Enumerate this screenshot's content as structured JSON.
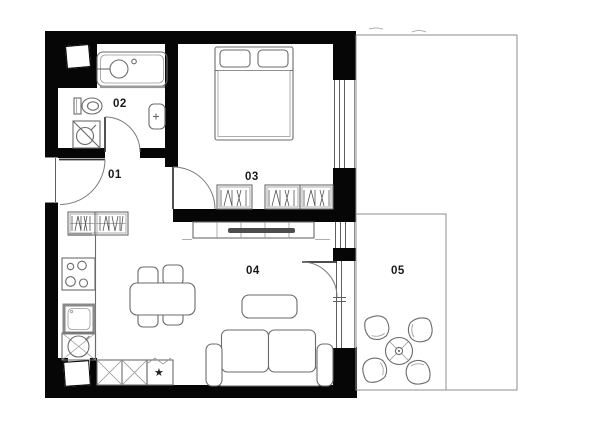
{
  "plan": {
    "rooms": [
      {
        "id": "01",
        "name": "hall"
      },
      {
        "id": "02",
        "name": "bathroom"
      },
      {
        "id": "03",
        "name": "bedroom"
      },
      {
        "id": "04",
        "name": "living room with kitchen"
      },
      {
        "id": "05",
        "name": "terrace"
      }
    ],
    "symbols": {
      "dishwasher_star": "★"
    }
  },
  "colors": {
    "wall": "#060606",
    "line": "#6b6b6b",
    "light": "#999999",
    "tv": "#4d4d4d",
    "label": "#1a1a1a",
    "thin": "#8c8c8c"
  }
}
